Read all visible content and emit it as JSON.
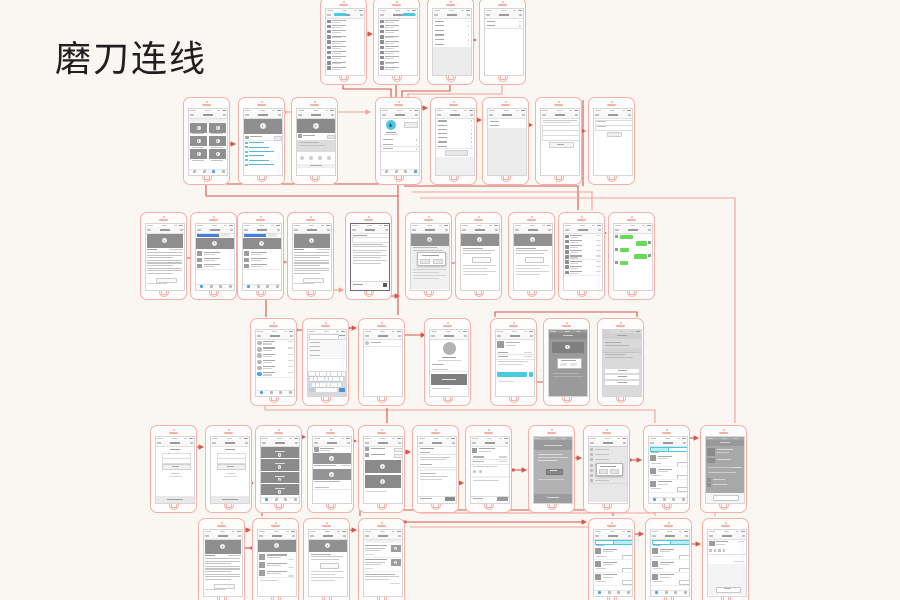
{
  "title": "磨刀连线",
  "colors": {
    "background": "#faf6f1",
    "frame": "#f4b0a9",
    "connector_dark": "#d6554c",
    "connector_light": "#f2a19a",
    "accent_cyan": "#49c8e2",
    "accent_cyan_light": "#bfeaf3",
    "accent_blue": "#4a7de0",
    "accent_green": "#67db57",
    "link_blue": "#58b5d8",
    "status_blue": "#4aa3e8",
    "block_gray": "#8f8f8f",
    "panel_gray": "#ececec"
  },
  "phones": [
    {
      "x": 320,
      "y": -3,
      "kind": "contacts"
    },
    {
      "x": 373,
      "y": -3,
      "kind": "contacts2"
    },
    {
      "x": 427,
      "y": -3,
      "kind": "settings"
    },
    {
      "x": 479,
      "y": -3,
      "kind": "form2"
    },
    {
      "x": 183,
      "y": 97,
      "kind": "videogrid"
    },
    {
      "x": 238,
      "y": 97,
      "kind": "videodetail"
    },
    {
      "x": 291,
      "y": 97,
      "kind": "sharedetail"
    },
    {
      "x": 375,
      "y": 97,
      "kind": "hubprofile"
    },
    {
      "x": 430,
      "y": 97,
      "kind": "settingsbtn"
    },
    {
      "x": 482,
      "y": 97,
      "kind": "rows2gray"
    },
    {
      "x": 535,
      "y": 97,
      "kind": "formbtn"
    },
    {
      "x": 588,
      "y": 97,
      "kind": "form3"
    },
    {
      "x": 140,
      "y": 212,
      "kind": "article"
    },
    {
      "x": 190,
      "y": 212,
      "kind": "feedblue"
    },
    {
      "x": 237,
      "y": 212,
      "kind": "feedblue"
    },
    {
      "x": 287,
      "y": 212,
      "kind": "article"
    },
    {
      "x": 345,
      "y": 212,
      "kind": "textpage"
    },
    {
      "x": 405,
      "y": 212,
      "kind": "videomodal"
    },
    {
      "x": 455,
      "y": 212,
      "kind": "videotext"
    },
    {
      "x": 508,
      "y": 212,
      "kind": "videotext"
    },
    {
      "x": 558,
      "y": 212,
      "kind": "chatlist"
    },
    {
      "x": 608,
      "y": 212,
      "kind": "chatgreen"
    },
    {
      "x": 250,
      "y": 318,
      "kind": "avatarlist"
    },
    {
      "x": 302,
      "y": 318,
      "kind": "searchkb"
    },
    {
      "x": 358,
      "y": 318,
      "kind": "blankrow"
    },
    {
      "x": 424,
      "y": 318,
      "kind": "bigavatar"
    },
    {
      "x": 490,
      "y": 318,
      "kind": "cyanbtn"
    },
    {
      "x": 543,
      "y": 318,
      "kind": "darkdialog"
    },
    {
      "x": 597,
      "y": 318,
      "kind": "actionsheet"
    },
    {
      "x": 150,
      "y": 425,
      "kind": "login"
    },
    {
      "x": 205,
      "y": 425,
      "kind": "login"
    },
    {
      "x": 255,
      "y": 425,
      "kind": "darkfeed"
    },
    {
      "x": 307,
      "y": 425,
      "kind": "videocards"
    },
    {
      "x": 358,
      "y": 425,
      "kind": "listdark"
    },
    {
      "x": 412,
      "y": 425,
      "kind": "orderform"
    },
    {
      "x": 465,
      "y": 425,
      "kind": "orderdetail"
    },
    {
      "x": 528,
      "y": 425,
      "kind": "darkpage"
    },
    {
      "x": 583,
      "y": 425,
      "kind": "modallist"
    },
    {
      "x": 643,
      "y": 425,
      "kind": "ordertabs_l"
    },
    {
      "x": 700,
      "y": 425,
      "kind": "darkdetail"
    },
    {
      "x": 198,
      "y": 518,
      "kind": "article"
    },
    {
      "x": 252,
      "y": 518,
      "kind": "videolist"
    },
    {
      "x": 303,
      "y": 518,
      "kind": "videotext"
    },
    {
      "x": 358,
      "y": 518,
      "kind": "feedthumbs"
    },
    {
      "x": 588,
      "y": 518,
      "kind": "ordertabs_r"
    },
    {
      "x": 645,
      "y": 518,
      "kind": "ordertabs_r"
    },
    {
      "x": 702,
      "y": 518,
      "kind": "commentbox"
    }
  ],
  "connectors": [
    {
      "p": [
        [
          345,
          34
        ],
        [
          372,
          34
        ]
      ],
      "c": "d",
      "a": 1
    },
    {
      "p": [
        [
          452,
          40
        ],
        [
          476,
          40
        ]
      ],
      "c": "d",
      "a": 1
    },
    {
      "p": [
        [
          343,
          83
        ],
        [
          343,
          89
        ],
        [
          391,
          89
        ],
        [
          391,
          111
        ]
      ],
      "c": "d"
    },
    {
      "p": [
        [
          396,
          83
        ],
        [
          396,
          111
        ]
      ],
      "c": "d"
    },
    {
      "p": [
        [
          450,
          83
        ],
        [
          450,
          91
        ],
        [
          402,
          91
        ],
        [
          402,
          111
        ]
      ],
      "c": "d"
    },
    {
      "p": [
        [
          502,
          80
        ],
        [
          502,
          94
        ],
        [
          408,
          94
        ],
        [
          408,
          111
        ]
      ],
      "c": "l"
    },
    {
      "p": [
        [
          412,
          108
        ],
        [
          427,
          108
        ]
      ],
      "c": "d",
      "a": 1
    },
    {
      "p": [
        [
          468,
          120
        ],
        [
          481,
          120
        ]
      ],
      "c": "d",
      "a": 1
    },
    {
      "p": [
        [
          505,
          125
        ],
        [
          532,
          125
        ]
      ],
      "c": "d",
      "a": 1
    },
    {
      "p": [
        [
          558,
          131
        ],
        [
          585,
          131
        ]
      ],
      "c": "d",
      "a": 1
    },
    {
      "p": [
        [
          285,
          112
        ],
        [
          370,
          112
        ]
      ],
      "c": "l",
      "a": 1
    },
    {
      "p": [
        [
          227,
          144
        ],
        [
          235,
          144
        ]
      ],
      "c": "d",
      "a": 1
    },
    {
      "p": [
        [
          398,
          185
        ],
        [
          398,
          315
        ]
      ],
      "c": "d"
    },
    {
      "p": [
        [
          222,
          184
        ],
        [
          398,
          184
        ]
      ],
      "c": "d"
    },
    {
      "p": [
        [
          206,
          185
        ],
        [
          206,
          196
        ],
        [
          398,
          196
        ]
      ],
      "c": "d"
    },
    {
      "p": [
        [
          404,
          186
        ],
        [
          578,
          186
        ],
        [
          578,
          210
        ]
      ],
      "c": "d"
    },
    {
      "p": [
        [
          412,
          192
        ],
        [
          592,
          192
        ],
        [
          592,
          210
        ]
      ],
      "c": "l"
    },
    {
      "p": [
        [
          583,
          100
        ],
        [
          583,
          186
        ]
      ],
      "c": "d"
    },
    {
      "p": [
        [
          420,
          198
        ],
        [
          735,
          198
        ],
        [
          735,
          423
        ]
      ],
      "c": "l"
    },
    {
      "p": [
        [
          152,
          258
        ],
        [
          196,
          258
        ]
      ],
      "c": "d",
      "a": 1
    },
    {
      "p": [
        [
          228,
          240
        ],
        [
          246,
          240
        ]
      ],
      "c": "d",
      "a": 1
    },
    {
      "p": [
        [
          283,
          262
        ],
        [
          304,
          262
        ]
      ],
      "c": "d",
      "a": 1
    },
    {
      "p": [
        [
          332,
          290
        ],
        [
          343,
          290
        ]
      ],
      "c": "l",
      "a": 1
    },
    {
      "p": [
        [
          368,
          296
        ],
        [
          399,
          296
        ]
      ],
      "c": "d",
      "a": 1
    },
    {
      "p": [
        [
          448,
          263
        ],
        [
          495,
          263
        ]
      ],
      "c": "d",
      "a": 1
    },
    {
      "p": [
        [
          600,
          233
        ],
        [
          606,
          233
        ]
      ],
      "c": "d",
      "a": 1
    },
    {
      "p": [
        [
          266,
          300
        ],
        [
          266,
          317
        ]
      ],
      "c": "d"
    },
    {
      "p": [
        [
          495,
          317
        ],
        [
          495,
          312
        ],
        [
          637,
          312
        ],
        [
          637,
          317
        ]
      ],
      "c": "d"
    },
    {
      "p": [
        [
          296,
          330
        ],
        [
          307,
          330
        ]
      ],
      "c": "d",
      "a": 1
    },
    {
      "p": [
        [
          348,
          328
        ],
        [
          356,
          328
        ]
      ],
      "c": "d",
      "a": 1
    },
    {
      "p": [
        [
          402,
          335
        ],
        [
          425,
          335
        ]
      ],
      "c": "d",
      "a": 1
    },
    {
      "p": [
        [
          535,
          382
        ],
        [
          555,
          382
        ]
      ],
      "c": "d",
      "a": 1
    },
    {
      "p": [
        [
          265,
          405
        ],
        [
          265,
          410
        ],
        [
          655,
          410
        ],
        [
          655,
          423
        ]
      ],
      "c": "l"
    },
    {
      "p": [
        [
          387,
          408
        ],
        [
          387,
          423
        ]
      ],
      "c": "d"
    },
    {
      "p": [
        [
          195,
          447
        ],
        [
          203,
          447
        ]
      ],
      "c": "d",
      "a": 1
    },
    {
      "p": [
        [
          248,
          483
        ],
        [
          253,
          483
        ]
      ],
      "c": "d",
      "a": 1
    },
    {
      "p": [
        [
          300,
          437
        ],
        [
          305,
          437
        ]
      ],
      "c": "d",
      "a": 1
    },
    {
      "p": [
        [
          350,
          441
        ],
        [
          356,
          441
        ]
      ],
      "c": "d",
      "a": 1
    },
    {
      "p": [
        [
          403,
          452
        ],
        [
          410,
          452
        ]
      ],
      "c": "d",
      "a": 1
    },
    {
      "p": [
        [
          458,
          483
        ],
        [
          463,
          483
        ]
      ],
      "c": "d",
      "a": 1
    },
    {
      "p": [
        [
          513,
          470
        ],
        [
          526,
          470
        ]
      ],
      "c": "d",
      "a": 1
    },
    {
      "p": [
        [
          570,
          458
        ],
        [
          581,
          458
        ]
      ],
      "c": "d",
      "a": 1
    },
    {
      "p": [
        [
          630,
          460
        ],
        [
          641,
          460
        ]
      ],
      "c": "d",
      "a": 1
    },
    {
      "p": [
        [
          688,
          438
        ],
        [
          698,
          438
        ]
      ],
      "c": "d",
      "a": 1
    },
    {
      "p": [
        [
          403,
          510
        ],
        [
          613,
          510
        ],
        [
          613,
          516
        ]
      ],
      "c": "d"
    },
    {
      "p": [
        [
          420,
          513
        ],
        [
          655,
          513
        ],
        [
          655,
          516
        ]
      ],
      "c": "l"
    },
    {
      "p": [
        [
          262,
          505
        ],
        [
          262,
          516
        ]
      ],
      "c": "d"
    },
    {
      "p": [
        [
          360,
          505
        ],
        [
          360,
          516
        ]
      ],
      "c": "d"
    },
    {
      "p": [
        [
          715,
          505
        ],
        [
          715,
          516
        ]
      ],
      "c": "l"
    },
    {
      "p": [
        [
          243,
          530
        ],
        [
          250,
          530
        ]
      ],
      "c": "d",
      "a": 1
    },
    {
      "p": [
        [
          252,
          548
        ],
        [
          236,
          548
        ]
      ],
      "c": "d",
      "a": 1
    },
    {
      "p": [
        [
          345,
          530
        ],
        [
          356,
          530
        ]
      ],
      "c": "d",
      "a": 1
    },
    {
      "p": [
        [
          405,
          522
        ],
        [
          586,
          522
        ]
      ],
      "c": "d",
      "a": 1
    },
    {
      "p": [
        [
          410,
          527
        ],
        [
          598,
          527
        ],
        [
          598,
          531
        ]
      ],
      "c": "l"
    },
    {
      "p": [
        [
          632,
          534
        ],
        [
          643,
          534
        ]
      ],
      "c": "d",
      "a": 1
    },
    {
      "p": [
        [
          690,
          544
        ],
        [
          700,
          544
        ]
      ],
      "c": "d",
      "a": 1
    }
  ]
}
